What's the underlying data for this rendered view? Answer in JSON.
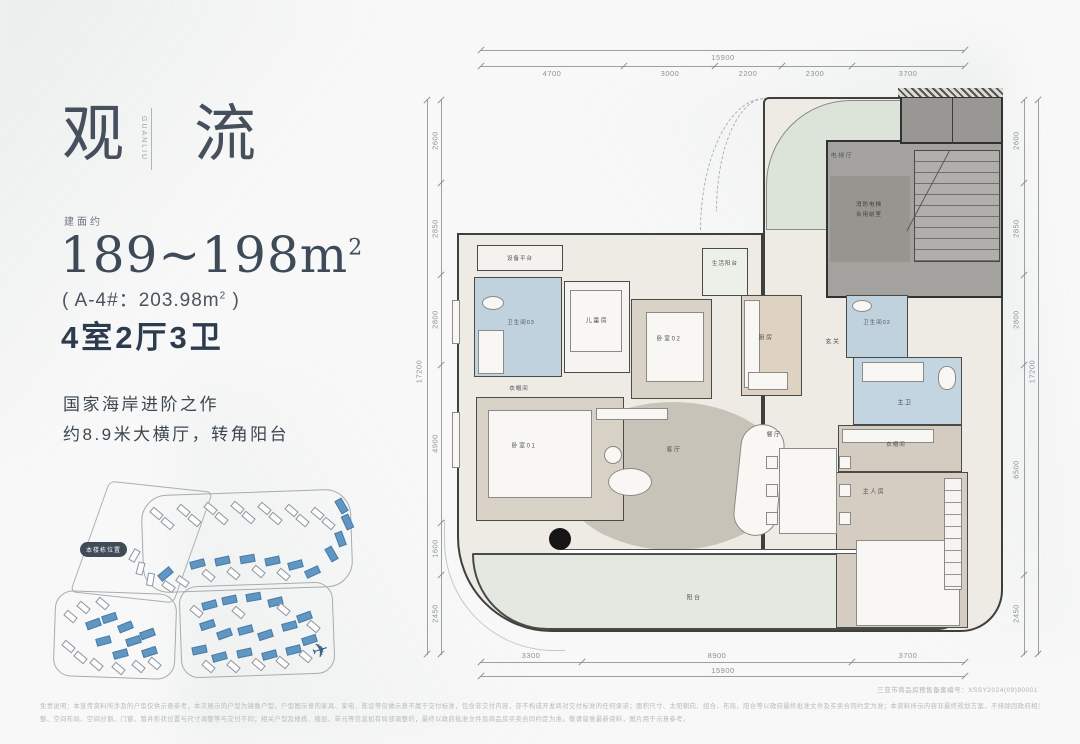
{
  "brand": {
    "title_left": "观",
    "title_right": "流",
    "title_vertical": "GUANLIU"
  },
  "area": {
    "prefix": "建面约",
    "range": "189~198m",
    "range_sup": "2",
    "detail_pre": "( A-4#：203.98m",
    "detail_sup": "2",
    "detail_post": " )",
    "layout": "4室2厅3卫"
  },
  "marketing": {
    "line1": "国家海岸进阶之作",
    "line2": "约8.9米大横厅，转角阳台"
  },
  "siteplan": {
    "badge": "本楼栋位置",
    "buildings": [
      [
        100,
        30,
        40,
        "w"
      ],
      [
        111,
        40,
        40,
        "w"
      ],
      [
        127,
        27,
        40,
        "w"
      ],
      [
        138,
        37,
        40,
        "w"
      ],
      [
        154,
        25,
        40,
        "w"
      ],
      [
        165,
        35,
        40,
        "w"
      ],
      [
        181,
        24,
        40,
        "w"
      ],
      [
        192,
        34,
        40,
        "w"
      ],
      [
        208,
        25,
        40,
        "w"
      ],
      [
        219,
        35,
        40,
        "w"
      ],
      [
        235,
        27,
        40,
        "w"
      ],
      [
        246,
        37,
        40,
        "w"
      ],
      [
        261,
        30,
        40,
        "w"
      ],
      [
        272,
        40,
        40,
        "w"
      ],
      [
        284,
        22,
        60,
        "b"
      ],
      [
        290,
        38,
        65,
        "b"
      ],
      [
        283,
        55,
        70,
        "b"
      ],
      [
        274,
        70,
        60,
        "b"
      ],
      [
        140,
        80,
        -15,
        "b"
      ],
      [
        165,
        77,
        -12,
        "b"
      ],
      [
        190,
        75,
        -10,
        "b"
      ],
      [
        215,
        77,
        -12,
        "b"
      ],
      [
        238,
        81,
        -15,
        "b"
      ],
      [
        255,
        88,
        -25,
        "b"
      ],
      [
        152,
        92,
        40,
        "w"
      ],
      [
        177,
        90,
        40,
        "w"
      ],
      [
        202,
        88,
        40,
        "w"
      ],
      [
        227,
        91,
        40,
        "w"
      ],
      [
        78,
        72,
        -60,
        "w"
      ],
      [
        84,
        85,
        -75,
        "w"
      ],
      [
        94,
        96,
        -80,
        "w"
      ],
      [
        112,
        103,
        35,
        "w"
      ],
      [
        126,
        98,
        35,
        "w"
      ],
      [
        108,
        90,
        -40,
        "b"
      ],
      [
        14,
        133,
        40,
        "w"
      ],
      [
        27,
        124,
        40,
        "w"
      ],
      [
        46,
        120,
        40,
        "w"
      ],
      [
        12,
        163,
        40,
        "w"
      ],
      [
        24,
        174,
        40,
        "w"
      ],
      [
        40,
        181,
        40,
        "w"
      ],
      [
        62,
        185,
        40,
        "w"
      ],
      [
        82,
        183,
        40,
        "w"
      ],
      [
        98,
        180,
        40,
        "w"
      ],
      [
        36,
        140,
        -20,
        "b"
      ],
      [
        52,
        134,
        -18,
        "b"
      ],
      [
        68,
        143,
        -22,
        "b"
      ],
      [
        46,
        157,
        -15,
        "b"
      ],
      [
        76,
        157,
        -18,
        "b"
      ],
      [
        90,
        150,
        -20,
        "b"
      ],
      [
        63,
        170,
        -15,
        "b"
      ],
      [
        92,
        168,
        -18,
        "b"
      ],
      [
        152,
        121,
        -15,
        "b"
      ],
      [
        172,
        116,
        -12,
        "b"
      ],
      [
        196,
        113,
        -10,
        "b"
      ],
      [
        218,
        118,
        -14,
        "b"
      ],
      [
        150,
        141,
        -18,
        "b"
      ],
      [
        167,
        150,
        -20,
        "b"
      ],
      [
        188,
        146,
        -15,
        "b"
      ],
      [
        208,
        151,
        -18,
        "b"
      ],
      [
        232,
        142,
        -15,
        "b"
      ],
      [
        247,
        133,
        -20,
        "b"
      ],
      [
        142,
        166,
        -12,
        "b"
      ],
      [
        162,
        173,
        -15,
        "b"
      ],
      [
        187,
        169,
        -12,
        "b"
      ],
      [
        212,
        171,
        -15,
        "b"
      ],
      [
        236,
        166,
        -14,
        "b"
      ],
      [
        252,
        156,
        -18,
        "b"
      ],
      [
        140,
        128,
        40,
        "w"
      ],
      [
        182,
        129,
        40,
        "w"
      ],
      [
        227,
        126,
        40,
        "w"
      ],
      [
        257,
        143,
        40,
        "w"
      ],
      [
        152,
        183,
        40,
        "w"
      ],
      [
        177,
        183,
        40,
        "w"
      ],
      [
        202,
        181,
        40,
        "w"
      ],
      [
        226,
        179,
        40,
        "w"
      ],
      [
        249,
        173,
        40,
        "w"
      ]
    ]
  },
  "plan": {
    "rooms": {
      "equipment": "设备平台",
      "service_balcony": "生活阳台",
      "elevator_hall": "电梯厅",
      "core_line1": "消防电梯",
      "core_line2": "合用前室",
      "bath03": "卫生间03",
      "kids": "儿童房",
      "bedroom02": "卧室02",
      "kitchen": "厨房",
      "foyer": "玄关",
      "bath02": "卫生间02",
      "master_bath": "主卫",
      "closet": "衣帽间",
      "closet2": "衣帽间",
      "master": "主人房",
      "bedroom01": "卧室01",
      "living": "客厅",
      "dining": "餐厅",
      "balcony": "阳台"
    }
  },
  "dims": {
    "top_total": "15900",
    "top": [
      "4700",
      "3000",
      "2200",
      "2300",
      "3700"
    ],
    "bottom_total": "15900",
    "bottom": [
      "3300",
      "8900",
      "3700"
    ],
    "left_total": "17200",
    "left": [
      "2600",
      "2850",
      "2800",
      "4900",
      "1600",
      "2450"
    ],
    "right_total": "17200",
    "right": [
      "2600",
      "2850",
      "2800",
      "6500",
      "2450"
    ]
  },
  "footer": {
    "record": "三亚市商品房预售备案编号：XSSY2024(09)90001",
    "disclaimer1": "免责说明：本宣传资料所涉及的户型仅供示意参考，本次展示的户型为镜像户型，户型图示意的家具、家电、陈设等仅做示意不属于交付标准，包含非交付内容，亦不构成开发商对交付标准的任何承诺；面积尺寸、太阳朝向、组合、布局、阳台等以政府最终批准文件及买卖合同约定为准；本资料所示内容非最终规划方案，不排除因政府相关规划、规定及开发商未能控制的原因而发生变化，不构成要约或承诺，不排除因政府规划调",
    "disclaimer2": "整、空间布局、空间分割、门窗、管井形状位置与尺寸调整等与交付不同；相关户型及楼栋、楼层、单元等信息如有局部调整的，最终以政府批准文件及商品房买卖合同约定为准。敬请留意最新资料，图片用于示意参考。"
  }
}
